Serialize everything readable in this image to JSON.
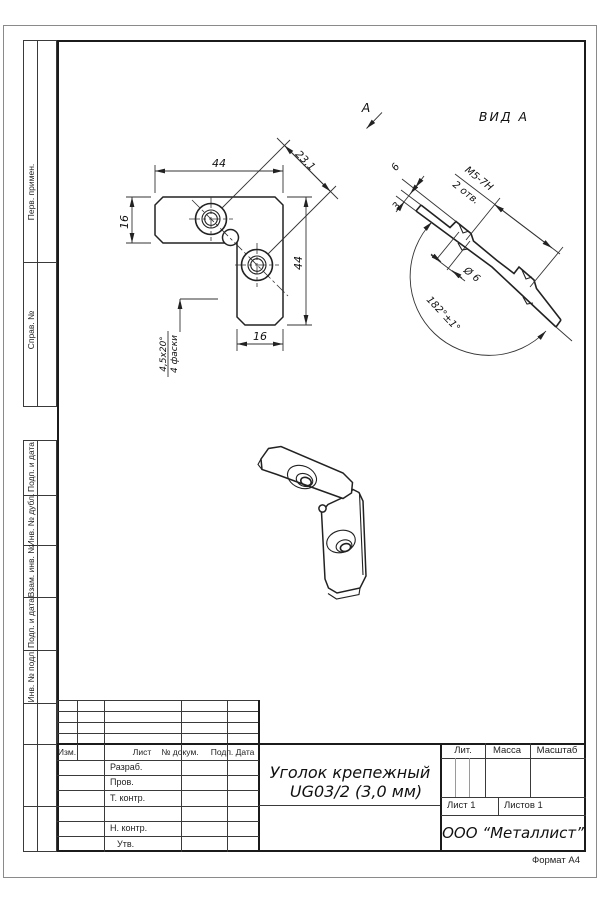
{
  "sheet": {
    "format_note": "Формат А4"
  },
  "margins": {
    "top_sections": [
      {
        "label": "Перв. примен."
      },
      {
        "label": "Справ. №"
      }
    ],
    "bottom_sections": [
      {
        "label": "Подп. и дата"
      },
      {
        "label": "Инв. № дубл."
      },
      {
        "label": "Взам. инв. №"
      },
      {
        "label": "Подп. и дата"
      },
      {
        "label": "Инв. № подл."
      }
    ]
  },
  "revision_header": {
    "izm": "Изм.",
    "list": "Лист",
    "doc": "№ докум.",
    "sign": "Подп.",
    "date": "Дата"
  },
  "roles": {
    "developed": "Разраб.",
    "checked": "Пров.",
    "tcontrol": "Т. контр.",
    "ncontrol": "Н. контр.",
    "approved": "Утв."
  },
  "title_block": {
    "name_line1": "Уголок крепежный",
    "name_line2": "UG03/2 (3,0 мм)",
    "lit": "Лит.",
    "mass": "Масса",
    "scale": "Масштаб",
    "sheet": "Лист 1",
    "sheets": "Листов 1",
    "company": "ООО “Металлист”"
  },
  "main_view": {
    "dim_top": "44",
    "dim_left": "16",
    "dim_right": "44",
    "dim_bottom": "16",
    "dim_diag": "23,1",
    "chamfer_size": "4,5x20°",
    "chamfer_count": "4 фаски"
  },
  "view_a": {
    "title": "ВИД А",
    "arrow": "A",
    "dim_6": "6",
    "dim_3": "3",
    "thread": "М5-7Н",
    "holes": "2 отв.",
    "dia": "Ø 6",
    "angle": "182°±1°"
  }
}
